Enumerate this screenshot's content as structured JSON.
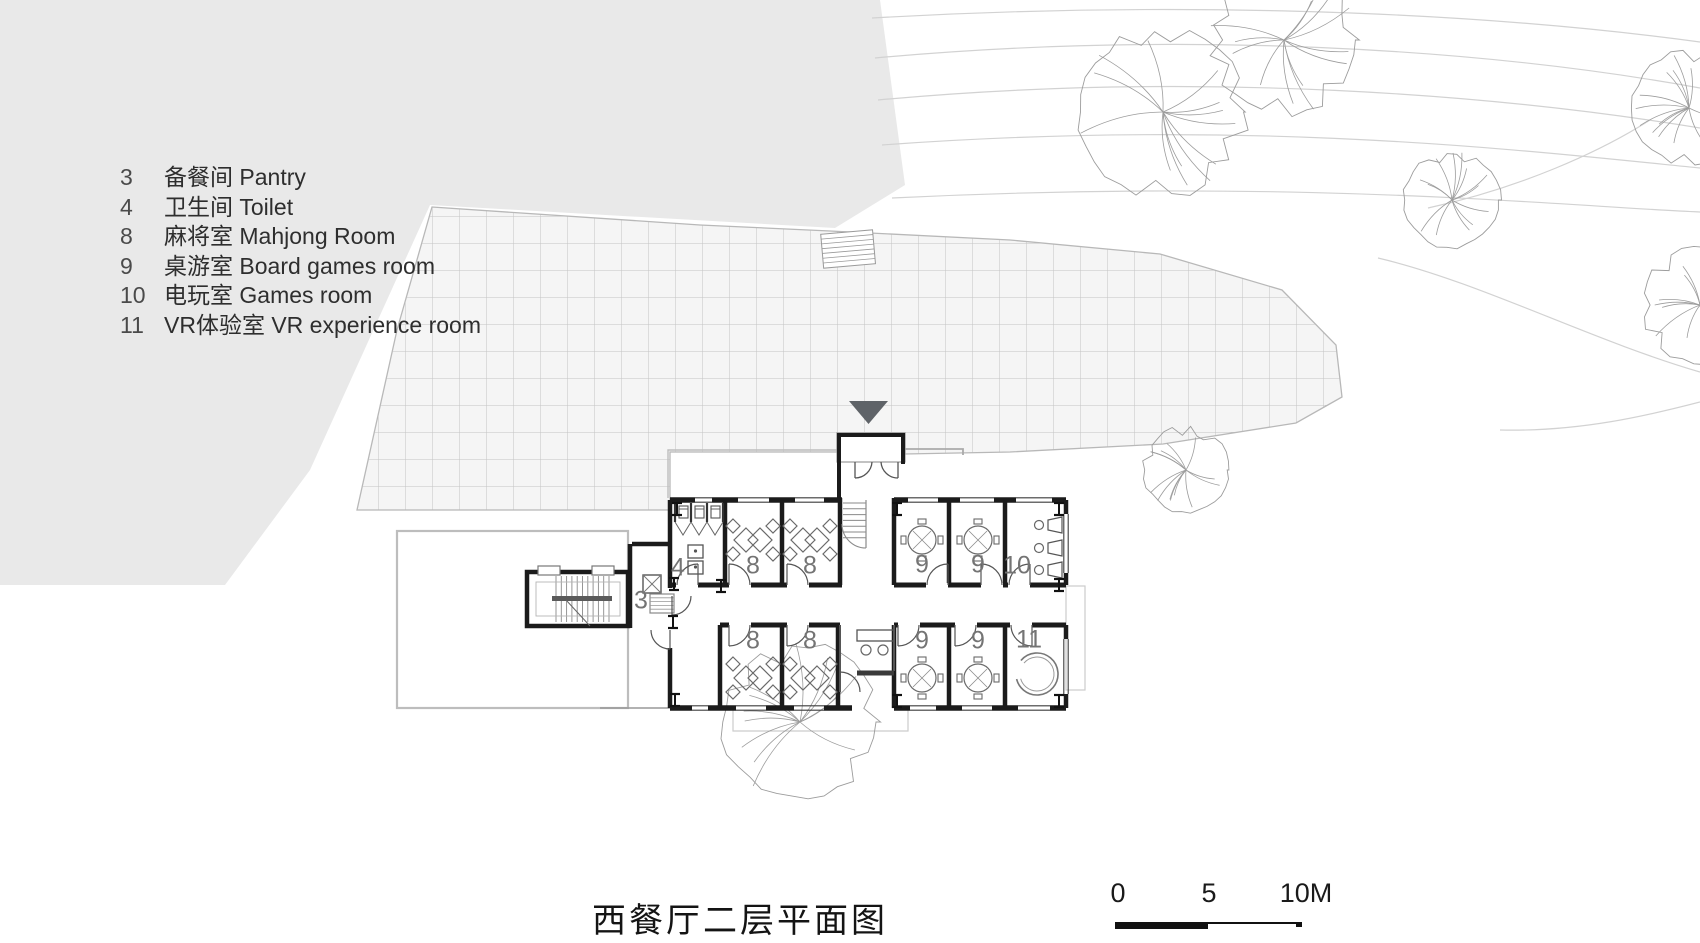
{
  "title": {
    "text": "西餐厅二层平面图"
  },
  "legend": {
    "items": [
      {
        "num": "3",
        "text": "备餐间 Pantry"
      },
      {
        "num": "4",
        "text": "卫生间 Toilet"
      },
      {
        "num": "8",
        "text": "麻将室 Mahjong Room"
      },
      {
        "num": "9",
        "text": "桌游室 Board games room"
      },
      {
        "num": "10",
        "text": "电玩室 Games room"
      },
      {
        "num": "11",
        "text": "VR体验室 VR experience room"
      }
    ]
  },
  "scale_bar": {
    "labels": [
      "0",
      "5",
      "10M"
    ]
  },
  "plan": {
    "room_labels": [
      {
        "id": "pantry",
        "text": "3",
        "x": 641,
        "y": 601
      },
      {
        "id": "toilet",
        "text": "4",
        "x": 678,
        "y": 568
      },
      {
        "id": "mahjong-1",
        "text": "8",
        "x": 753,
        "y": 566
      },
      {
        "id": "mahjong-2",
        "text": "8",
        "x": 810,
        "y": 566
      },
      {
        "id": "mahjong-3",
        "text": "8",
        "x": 753,
        "y": 641
      },
      {
        "id": "mahjong-4",
        "text": "8",
        "x": 810,
        "y": 641
      },
      {
        "id": "board-games-1",
        "text": "9",
        "x": 922,
        "y": 565
      },
      {
        "id": "board-games-2",
        "text": "9",
        "x": 978,
        "y": 565
      },
      {
        "id": "board-games-3",
        "text": "9",
        "x": 922,
        "y": 641
      },
      {
        "id": "board-games-4",
        "text": "9",
        "x": 978,
        "y": 641
      },
      {
        "id": "games-room",
        "text": "10",
        "x": 1017,
        "y": 566
      },
      {
        "id": "vr-room",
        "text": "11",
        "x": 1029,
        "y": 640
      }
    ]
  },
  "site": {
    "trees": [
      {
        "x": 1163,
        "y": 112,
        "r": 86
      },
      {
        "x": 1284,
        "y": 40,
        "r": 76
      },
      {
        "x": 1452,
        "y": 200,
        "r": 49
      },
      {
        "x": 1689,
        "y": 108,
        "r": 58
      },
      {
        "x": 1700,
        "y": 305,
        "r": 60
      },
      {
        "x": 1186,
        "y": 470,
        "r": 44
      },
      {
        "x": 800,
        "y": 722,
        "r": 80
      }
    ]
  },
  "colors": {
    "site_fill": "#e9e9e9",
    "terrace_fill": "#f5f5f5",
    "grid_line": "#c3c3c3",
    "terrace_edge": "#b8b8b8",
    "wall": "#1b1b1b",
    "fixture": "#4a4a4a",
    "room_label": "#747474",
    "tree_stroke": "#9c9c9c",
    "contour": "#d2d2d2",
    "entrance_arrow": "#5f6368",
    "faint_outline": "#bdbdbd"
  }
}
